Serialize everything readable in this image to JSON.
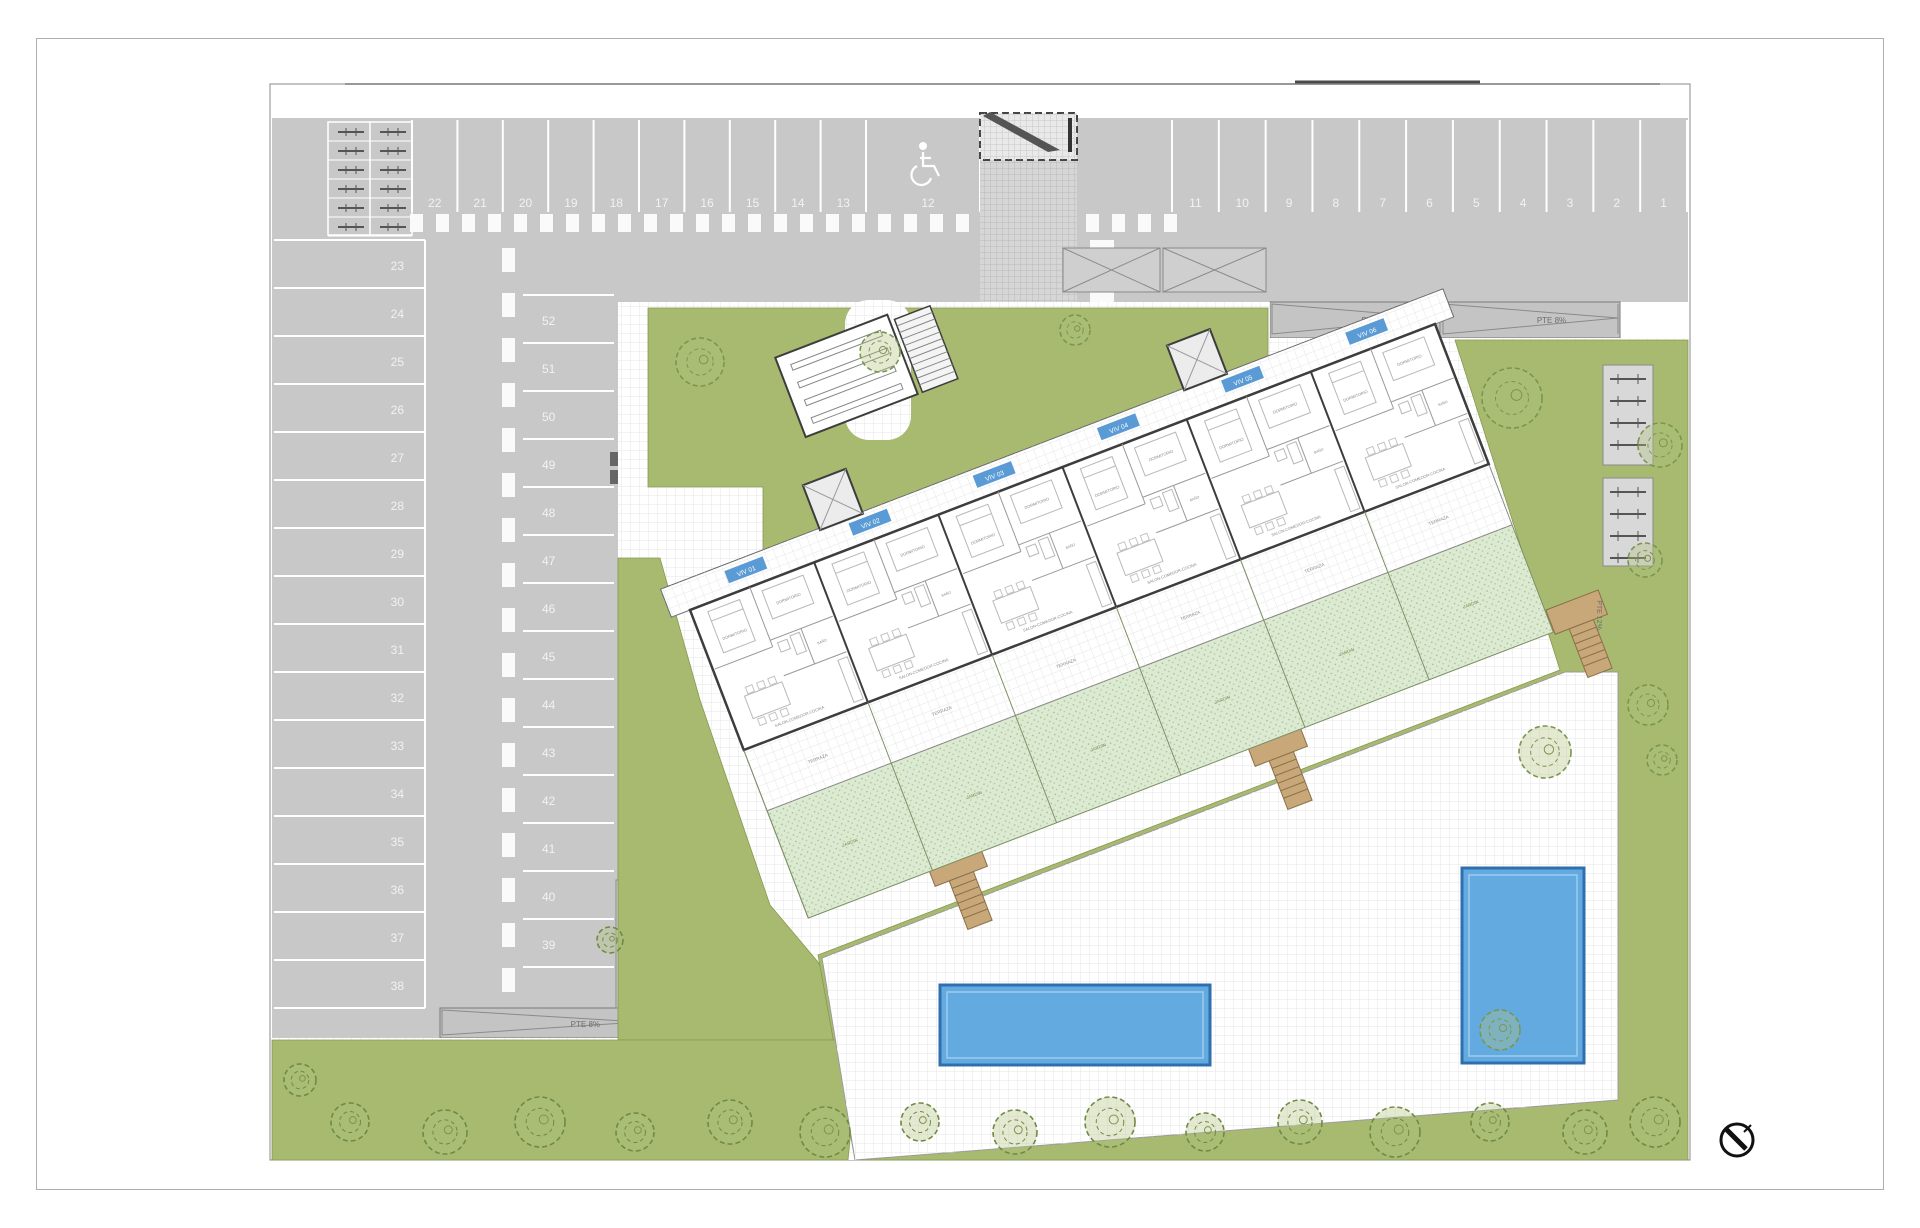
{
  "drawing": {
    "kind": "residential site plan",
    "north_arrow": "north-arrow"
  },
  "parking": {
    "top_row_left": [
      "22",
      "21",
      "20",
      "19",
      "18",
      "17",
      "16",
      "15",
      "14",
      "13"
    ],
    "accessible_space": {
      "number": "12",
      "icon": "wheelchair-icon"
    },
    "top_row_right": [
      "11",
      "10",
      "9",
      "8",
      "7",
      "6",
      "5",
      "4",
      "3",
      "2",
      "1"
    ],
    "west_column": [
      "23",
      "24",
      "25",
      "26",
      "27",
      "28",
      "29",
      "30",
      "31",
      "32",
      "33",
      "34",
      "35",
      "36",
      "37",
      "38"
    ],
    "center_column": [
      "52",
      "51",
      "50",
      "49",
      "48",
      "47",
      "46",
      "45",
      "44",
      "43",
      "42",
      "41",
      "40",
      "39"
    ]
  },
  "ramps": {
    "northeast": [
      "PTE 8%",
      "PTE 8%"
    ],
    "south": "PTE 8%",
    "center": "PTE 6%",
    "east": "PTE 12%"
  },
  "building": {
    "unit_badges": [
      "VIV 01",
      "VIV 02",
      "VIV 03",
      "VIV 04",
      "VIV 05",
      "VIV 06"
    ],
    "room_labels": {
      "bedroom": "DORMITORIO",
      "living": "SALON-COMEDOR-COCINA",
      "bath": "BAÑO",
      "terrace": "TERRAZA",
      "garden": "JARDIN"
    }
  },
  "colors": {
    "asphalt": "#c8c8c8",
    "stall_line": "#ffffff",
    "lawn": "#a7ba70",
    "private_garden": "#dcead2",
    "pool": "#63aae1",
    "pool_border": "#2f6fad",
    "wood": "#c8a878",
    "wall": "#3d3d3d",
    "badge": "#5b9bd5",
    "ramp_text": "#6e6e6e",
    "tree_stroke": "#7c954e"
  }
}
